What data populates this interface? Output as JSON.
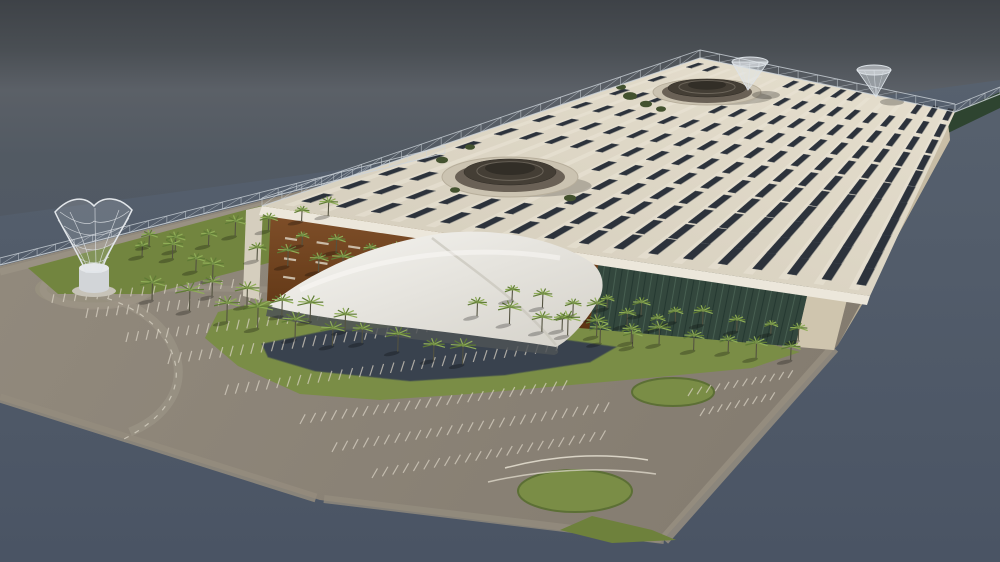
{
  "meta": {
    "title": "Aerial 3D architectural rendering of a solar-roofed exhibition complex with tensile entrance canopy, palm-lined lawns, pond, curved parking and wireframe sculpture tower"
  },
  "sky": {
    "stops": [
      [
        "0%",
        "#3e4247"
      ],
      [
        "9%",
        "#4a4f54"
      ],
      [
        "16%",
        "#5b6067"
      ],
      [
        "28%",
        "#525a63"
      ],
      [
        "60%",
        "#4f5766"
      ],
      [
        "100%",
        "#4d5667"
      ]
    ]
  },
  "ground": {
    "poly": [
      [
        0,
        216
      ],
      [
        1000,
        80
      ],
      [
        1000,
        562
      ],
      [
        0,
        562
      ]
    ],
    "from": "#57616e",
    "to": "#4a5464"
  },
  "site": {
    "poly": [
      [
        0,
        266
      ],
      [
        447,
        154
      ],
      [
        700,
        62
      ],
      [
        950,
        114
      ],
      [
        950,
        140
      ],
      [
        838,
        345
      ],
      [
        660,
        543
      ],
      [
        320,
        500
      ],
      [
        0,
        400
      ]
    ],
    "from": "#938b7e",
    "to": "#847c70"
  },
  "plaza": {
    "cx": 95,
    "cy": 289,
    "rx": 60,
    "ry": 19,
    "c": "#97907f"
  },
  "roads": [
    {
      "d": "M 0,272 L 444,160",
      "w": 7,
      "c": "#9a9284",
      "o": 0.9
    },
    {
      "d": "M 0,398 L 316,498",
      "w": 9,
      "c": "#948c7e",
      "o": 0.85
    },
    {
      "d": "M 834,348 L 664,540",
      "w": 11,
      "c": "#968e80",
      "o": 0.85
    },
    {
      "d": "M 664,540 L 324,499",
      "w": 8,
      "c": "#948c7e",
      "o": 0.8
    },
    {
      "d": "M 84,290 C 150,304 174,336 178,366 C 181,396 160,420 130,432",
      "w": 9,
      "c": "#9a9284",
      "o": 0.8
    },
    {
      "d": "M 60,292 C 200,284 340,290 470,302",
      "w": 6,
      "c": "#9a9284",
      "o": 0.7
    }
  ],
  "plazaRing": {
    "cx": 95,
    "cy": 289,
    "rx": 52,
    "ry": 17,
    "w": 7,
    "c": "#9c9486",
    "o": 0.8
  },
  "lawns": [
    {
      "pts": [
        [
          28,
          268
        ],
        [
          444,
          157
        ],
        [
          466,
          169
        ],
        [
          310,
          252
        ],
        [
          150,
          294
        ],
        [
          58,
          294
        ]
      ],
      "c": "#72853f"
    },
    {
      "pts": [
        [
          218,
          312
        ],
        [
          320,
          289
        ],
        [
          430,
          288
        ],
        [
          540,
          302
        ],
        [
          640,
          318
        ],
        [
          740,
          336
        ],
        [
          800,
          352
        ],
        [
          752,
          368
        ],
        [
          648,
          378
        ],
        [
          560,
          386
        ],
        [
          470,
          394
        ],
        [
          380,
          400
        ],
        [
          300,
          394
        ],
        [
          238,
          366
        ],
        [
          205,
          338
        ]
      ],
      "c": "#7a8d46"
    },
    {
      "pts": [
        [
          592,
          516
        ],
        [
          652,
          530
        ],
        [
          676,
          540
        ],
        [
          612,
          543
        ],
        [
          560,
          530
        ]
      ],
      "c": "#6e813c"
    }
  ],
  "circles": [
    {
      "cx": 673,
      "cy": 392,
      "rx": 41,
      "ry": 14,
      "c": "#7a8d46",
      "s": "#5c6f35"
    },
    {
      "cx": 575,
      "cy": 491,
      "rx": 57,
      "ry": 21,
      "c": "#7a8d46",
      "s": "#5c6f35"
    }
  ],
  "hedge": {
    "pts": [
      [
        938,
        120
      ],
      [
        1000,
        92
      ],
      [
        1000,
        108
      ],
      [
        946,
        134
      ]
    ],
    "c": "#2e4430"
  },
  "pond": {
    "pts": [
      [
        262,
        344
      ],
      [
        330,
        330
      ],
      [
        420,
        327
      ],
      [
        500,
        332
      ],
      [
        566,
        340
      ],
      [
        616,
        347
      ],
      [
        590,
        362
      ],
      [
        505,
        375
      ],
      [
        410,
        381
      ],
      [
        315,
        371
      ],
      [
        268,
        357
      ]
    ],
    "c": "#39424e",
    "s": "#49584c"
  },
  "parking": {
    "tick": {
      "c": "#dad3c5",
      "w": 1.2,
      "o": 0.72
    },
    "bands": [
      {
        "a": [
          52,
          303
        ],
        "b": [
          243,
          287
        ],
        "n": 18,
        "ang": -78,
        "len": 9
      },
      {
        "a": [
          86,
          318
        ],
        "b": [
          320,
          297
        ],
        "n": 24,
        "ang": -78,
        "len": 10
      },
      {
        "a": [
          126,
          342
        ],
        "b": [
          418,
          309
        ],
        "n": 30,
        "ang": -76,
        "len": 10
      },
      {
        "a": [
          168,
          364
        ],
        "b": [
          468,
          327
        ],
        "n": 30,
        "ang": -74,
        "len": 11
      },
      {
        "a": [
          225,
          395
        ],
        "b": [
          556,
          351
        ],
        "n": 33,
        "ang": -72,
        "len": 11
      },
      {
        "a": [
          300,
          424
        ],
        "b": [
          562,
          390
        ],
        "n": 26,
        "ang": -62,
        "len": 11
      },
      {
        "a": [
          332,
          452
        ],
        "b": [
          604,
          412
        ],
        "n": 27,
        "ang": -62,
        "len": 11
      },
      {
        "a": [
          372,
          478
        ],
        "b": [
          600,
          440
        ],
        "n": 23,
        "ang": -60,
        "len": 11
      },
      {
        "a": [
          688,
          396
        ],
        "b": [
          788,
          378
        ],
        "n": 12,
        "ang": -58,
        "len": 9
      },
      {
        "a": [
          700,
          416
        ],
        "b": [
          770,
          400
        ],
        "n": 9,
        "ang": -58,
        "len": 9
      }
    ]
  },
  "markings": [
    {
      "d": "M 505,468 C 550,456 600,452 648,460",
      "w": 1.5,
      "c": "#e8e2d4",
      "o": 0.85,
      "dash": ""
    },
    {
      "d": "M 488,482 C 540,470 600,466 656,474",
      "w": 1.5,
      "c": "#e8e2d4",
      "o": 0.7,
      "dash": ""
    },
    {
      "d": "M 84,292 C 150,306 172,340 176,368 C 179,398 158,422 122,440",
      "w": 1.2,
      "c": "#eae4d6",
      "o": 0.6,
      "dash": "5 7"
    }
  ],
  "fence": {
    "a": [
      0,
      265
    ],
    "b": [
      445,
      153
    ],
    "h": 7,
    "n": 24,
    "c": "#cdd4da"
  },
  "building": {
    "roof": {
      "L": [
        262,
        206
      ],
      "B": [
        700,
        58
      ],
      "R": [
        955,
        112
      ],
      "F": [
        870,
        296
      ],
      "cols": 17,
      "rows": 11,
      "from": "#d3ccbb",
      "to": "#e6dfce",
      "strip": "#ece6d8",
      "panel": "#2c323b",
      "panelEdge": "#cfc9ba",
      "panelStroke": "#3a414b"
    },
    "fascia": {
      "pts": [
        [
          262,
          206
        ],
        [
          870,
          296
        ],
        [
          867,
          305
        ],
        [
          259,
          215
        ]
      ],
      "c": "#ece7db"
    },
    "frontTop": [
      [
        262,
        206
      ],
      [
        870,
        296
      ]
    ],
    "frontBot": [
      [
        258,
        300
      ],
      [
        855,
        352
      ]
    ],
    "segs": {
      "brown": [
        0.015,
        0.555
      ],
      "louver": [
        0.555,
        0.9
      ],
      "cap": [
        0.9,
        0.965
      ]
    },
    "brown": {
      "from": "#80502a",
      "to": "#5d3413"
    },
    "slots": {
      "c": "#d9d0bf",
      "rows": [
        0.3,
        0.52,
        0.72
      ],
      "n": 10,
      "range": [
        0.05,
        0.52
      ]
    },
    "louver": {
      "base": "#33473d",
      "dark": "#243730",
      "light": "#4a6254",
      "n": 34,
      "range": [
        0.565,
        0.89
      ]
    },
    "capC": "#cfc5ae",
    "westWall": {
      "pts": [
        [
          246,
          210
        ],
        [
          263,
          206
        ],
        [
          259,
          300
        ],
        [
          243,
          296
        ]
      ],
      "c": "#d5cebe"
    },
    "endwall": {
      "pts": [
        [
          866,
          298
        ],
        [
          947,
          114
        ],
        [
          950,
          140
        ],
        [
          838,
          345
        ]
      ],
      "from": "#d6ccb6",
      "to": "#b2a68d"
    },
    "domes": [
      {
        "cx": 510,
        "cy": 177,
        "plat": [
          68,
          20
        ],
        "ring": [
          55,
          15
        ],
        "body": [
          46,
          13
        ],
        "cap": [
          25,
          7
        ],
        "lift": 5,
        "skip": [
          78,
          27
        ]
      },
      {
        "cx": 707,
        "cy": 92,
        "plat": [
          54,
          13
        ],
        "ring": [
          45,
          11
        ],
        "body": [
          39,
          9
        ],
        "cap": [
          19,
          5
        ],
        "lift": 4,
        "skip": [
          64,
          19
        ]
      }
    ],
    "funnels": [
      {
        "apex": [
          748,
          90
        ],
        "top": [
          750,
          62
        ],
        "rx": 18,
        "ry": 5,
        "sh": [
          766,
          95,
          14,
          4
        ]
      },
      {
        "apex": [
          876,
          97
        ],
        "top": [
          874,
          70
        ],
        "rx": 17,
        "ry": 5,
        "sh": [
          892,
          102,
          12,
          3.5
        ]
      }
    ],
    "bushes": [
      [
        630,
        96,
        7
      ],
      [
        646,
        104,
        6
      ],
      [
        661,
        109,
        5
      ],
      [
        621,
        87,
        5
      ],
      [
        442,
        160,
        6
      ],
      [
        455,
        190,
        5
      ],
      [
        570,
        198,
        6
      ],
      [
        470,
        147,
        5
      ]
    ],
    "bushC": "#43522f",
    "trusses": [
      {
        "a": [
          262,
          206
        ],
        "b": [
          700,
          58
        ],
        "h": 8,
        "n": 22
      },
      {
        "a": [
          700,
          58
        ],
        "b": [
          955,
          112
        ],
        "h": 8,
        "n": 13
      },
      {
        "a": [
          955,
          112
        ],
        "b": [
          1000,
          94
        ],
        "h": 7,
        "n": 3
      }
    ],
    "trussC": "#cdd4da"
  },
  "canopy": {
    "main": "M 268,306 C 315,268 378,242 445,233 C 502,227 560,241 592,263 C 604,273 606,289 597,303 C 580,330 566,342 556,347 C 498,338 430,330 368,323 C 328,318 294,313 268,306 Z",
    "from": "#f6f5f1",
    "to": "#d4d1c9",
    "shadow": "M 268,306 C 360,318 470,330 556,347 C 560,352 558,354 554,355 C 458,344 348,334 266,316 Z",
    "shadowC": "#4d5256",
    "folds": [
      {
        "d": "M 432,238 C 470,268 520,300 556,345",
        "c": "#c7c4bb",
        "w": 2.5,
        "o": 0.7
      },
      {
        "d": "M 300,290 C 380,255 470,244 560,258",
        "c": "#fbfaf8",
        "w": 5,
        "o": 0.5
      }
    ]
  },
  "palms": {
    "trunk": "#545341",
    "frond1": "#8fae57",
    "frond2": "#5f7b35",
    "shadow": "rgba(0,0,0,0.25)",
    "rows": [
      {
        "a": [
          145,
          258
        ],
        "b": [
          330,
          215
        ],
        "n": 7,
        "h": 13,
        "layer": "back"
      },
      {
        "a": [
          260,
          262
        ],
        "b": [
          430,
          286
        ],
        "n": 7,
        "h": 15,
        "layer": "back"
      },
      {
        "a": [
          305,
          247
        ],
        "b": [
          432,
          266
        ],
        "n": 5,
        "h": 12,
        "layer": "back"
      },
      {
        "a": [
          152,
          248
        ],
        "b": [
          215,
          280
        ],
        "n": 4,
        "h": 14,
        "layer": "back"
      },
      {
        "a": [
          155,
          302
        ],
        "b": [
          330,
          347
        ],
        "n": 6,
        "h": 20,
        "layer": "front"
      },
      {
        "a": [
          215,
          298
        ],
        "b": [
          345,
          330
        ],
        "n": 5,
        "h": 17,
        "layer": "front"
      },
      {
        "a": [
          365,
          345
        ],
        "b": [
          465,
          365
        ],
        "n": 4,
        "h": 17,
        "layer": "front"
      },
      {
        "a": [
          480,
          318
        ],
        "b": [
          630,
          348
        ],
        "n": 6,
        "h": 16,
        "layer": "front"
      },
      {
        "a": [
          515,
          302
        ],
        "b": [
          655,
          330
        ],
        "n": 6,
        "h": 13,
        "layer": "front"
      },
      {
        "a": [
          565,
          332
        ],
        "b": [
          790,
          362
        ],
        "n": 8,
        "h": 15,
        "layer": "front"
      },
      {
        "a": [
          610,
          310
        ],
        "b": [
          800,
          340
        ],
        "n": 7,
        "h": 12,
        "layer": "front"
      }
    ]
  },
  "sculpture": {
    "stroke": "#e2e6ea",
    "fill": "rgba(222,228,234,0.16)",
    "outline": "M 86,272 C 78,252 64,232 55,212 C 70,196 85,196 94,206 C 103,196 119,196 132,210 C 122,231 107,252 101,272 Z",
    "lines": [
      "M 60,212 C 76,224 90,226 94,221",
      "M 94,221 C 100,224 116,222 129,211",
      "M 70,212 C 81,234 89,254 91,270",
      "M 95,208 C 95,232 96,254 96,270",
      "M 119,210 C 110,234 101,254 98,270",
      "M 58,220 C 74,242 85,260 89,272",
      "M 129,218 C 114,242 103,260 99,272",
      "M 64,226 C 85,239 106,238 126,224",
      "M 71,243 C 88,253 101,252 116,241",
      "M 79,258 C 90,265 99,264 109,257"
    ],
    "baseTop": {
      "cx": 94,
      "cy": 268,
      "rx": 15,
      "ry": 5,
      "c": "#e6e8ea"
    },
    "baseBody": "M 79,268 L 79,288 A 15 5 0 0 0 109,288 L 109,268 Z",
    "baseC": "#d2d5d8",
    "pedestal": {
      "cx": 94,
      "cy": 291,
      "rx": 22,
      "ry": 6,
      "c": "#c7c3b8"
    }
  }
}
